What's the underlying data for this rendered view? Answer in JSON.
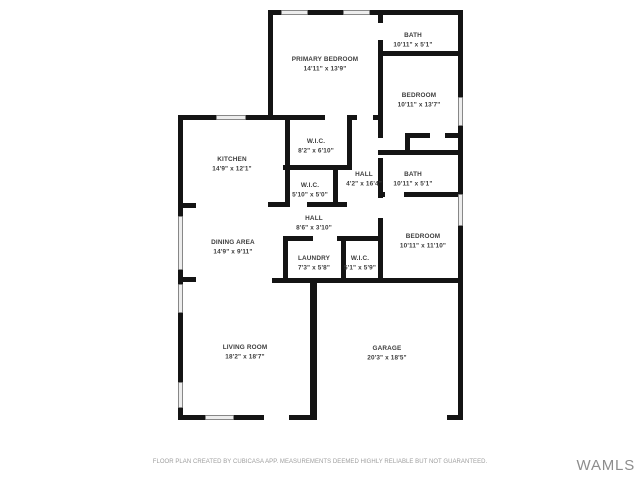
{
  "colors": {
    "wall": "#141414",
    "window_fill": "#ededed",
    "window_stroke": "#8a8a8a",
    "label": "#3d3d3d",
    "footer": "#9e9e9e",
    "watermark": "#8d8d8d"
  },
  "floorplan": {
    "rooms": [
      {
        "id": "primary-bedroom",
        "name": "PRIMARY BEDROOM",
        "dims": "14'11\" x 13'9\"",
        "x": 325,
        "y": 61
      },
      {
        "id": "bath-top",
        "name": "BATH",
        "dims": "10'11\" x 5'1\"",
        "x": 413,
        "y": 37
      },
      {
        "id": "bedroom-right",
        "name": "BEDROOM",
        "dims": "10'11\" x 13'7\"",
        "x": 419,
        "y": 97
      },
      {
        "id": "kitchen",
        "name": "KITCHEN",
        "dims": "14'9\" x 12'1\"",
        "x": 232,
        "y": 161
      },
      {
        "id": "wic-primary",
        "name": "W.I.C.",
        "dims": "8'2\" x 6'10\"",
        "x": 316,
        "y": 143
      },
      {
        "id": "wic-middle",
        "name": "W.I.C.",
        "dims": "5'10\" x 5'0\"",
        "x": 310,
        "y": 187
      },
      {
        "id": "hall-vertical",
        "name": "HALL",
        "dims": "4'2\" x 16'4\"",
        "x": 364,
        "y": 176
      },
      {
        "id": "bath-middle",
        "name": "BATH",
        "dims": "10'11\" x 5'1\"",
        "x": 413,
        "y": 176
      },
      {
        "id": "hall-lower",
        "name": "HALL",
        "dims": "8'6\" x 3'10\"",
        "x": 314,
        "y": 220
      },
      {
        "id": "dining-area",
        "name": "DINING AREA",
        "dims": "14'9\" x 9'11\"",
        "x": 233,
        "y": 244
      },
      {
        "id": "bedroom-lower",
        "name": "BEDROOM",
        "dims": "10'11\" x 11'10\"",
        "x": 423,
        "y": 238
      },
      {
        "id": "laundry",
        "name": "LAUNDRY",
        "dims": "7'3\" x 5'8\"",
        "x": 314,
        "y": 260
      },
      {
        "id": "wic-lower",
        "name": "W.I.C.",
        "dims": "5'1\" x 5'9\"",
        "x": 360,
        "y": 260
      },
      {
        "id": "living-room",
        "name": "LIVING ROOM",
        "dims": "18'2\" x 18'7\"",
        "x": 245,
        "y": 349
      },
      {
        "id": "garage",
        "name": "GARAGE",
        "dims": "20'3\" x 18'5\"",
        "x": 387,
        "y": 350
      }
    ],
    "walls": [
      [
        268,
        10,
        195,
        5
      ],
      [
        378,
        51,
        85,
        5
      ],
      [
        178,
        115,
        147,
        5
      ],
      [
        347,
        115,
        10,
        5
      ],
      [
        373,
        115,
        7,
        5
      ],
      [
        283,
        165,
        67,
        5
      ],
      [
        408,
        133,
        22,
        5
      ],
      [
        445,
        133,
        18,
        5
      ],
      [
        378,
        150,
        85,
        5
      ],
      [
        378,
        192,
        7,
        5
      ],
      [
        404,
        192,
        59,
        5
      ],
      [
        268,
        202,
        20,
        5
      ],
      [
        307,
        202,
        40,
        5
      ],
      [
        283,
        236,
        30,
        5
      ],
      [
        337,
        236,
        43,
        5
      ],
      [
        272,
        278,
        191,
        5
      ],
      [
        178,
        277,
        18,
        5
      ],
      [
        178,
        203,
        18,
        5
      ],
      [
        178,
        415,
        86,
        5
      ],
      [
        289,
        415,
        28,
        5
      ],
      [
        447,
        415,
        16,
        5
      ],
      [
        268,
        10,
        5,
        110
      ],
      [
        178,
        115,
        5,
        305
      ],
      [
        458,
        10,
        5,
        410
      ],
      [
        378,
        10,
        5,
        13
      ],
      [
        378,
        40,
        5,
        98
      ],
      [
        378,
        158,
        5,
        40
      ],
      [
        378,
        218,
        5,
        65
      ],
      [
        405,
        133,
        5,
        22
      ],
      [
        285,
        115,
        5,
        92
      ],
      [
        347,
        115,
        5,
        55
      ],
      [
        333,
        167,
        5,
        40
      ],
      [
        283,
        238,
        5,
        45
      ],
      [
        341,
        238,
        5,
        45
      ],
      [
        310,
        278,
        7,
        142
      ]
    ],
    "windows": [
      [
        281,
        10,
        27,
        5
      ],
      [
        343,
        10,
        27,
        5
      ],
      [
        216,
        115,
        30,
        5
      ],
      [
        178,
        216,
        5,
        54
      ],
      [
        178,
        284,
        5,
        29
      ],
      [
        178,
        382,
        5,
        26
      ],
      [
        458,
        97,
        5,
        29
      ],
      [
        458,
        194,
        5,
        32
      ],
      [
        205,
        415,
        29,
        5
      ]
    ]
  },
  "footer": {
    "disclaimer": "FLOOR PLAN CREATED BY CUBICASA APP. MEASUREMENTS DEEMED HIGHLY RELIABLE BUT NOT GUARANTEED."
  },
  "watermark": {
    "text": "WAMLS"
  }
}
